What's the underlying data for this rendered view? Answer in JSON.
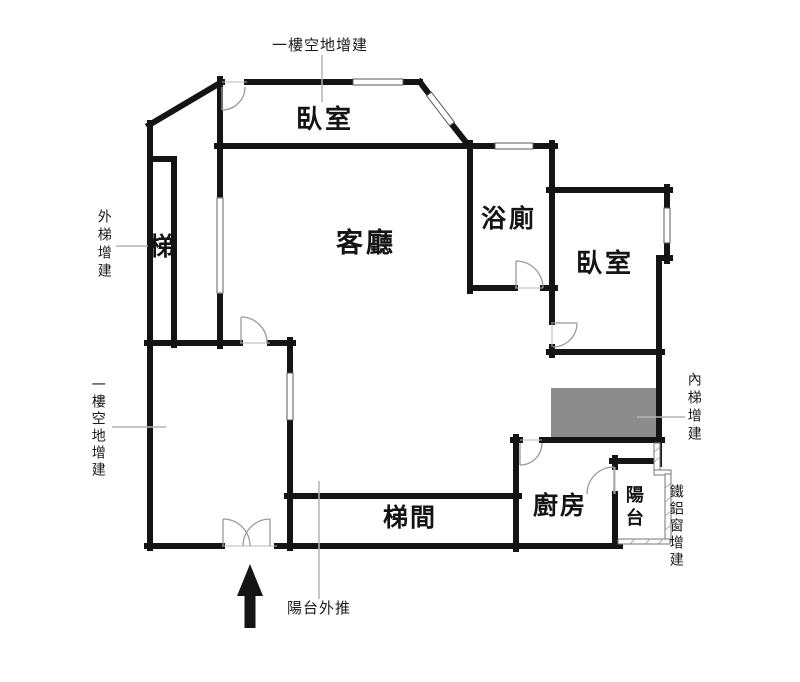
{
  "image_type": "apartment floor plan with addition annotations",
  "rooms": {
    "bedroom_top": "臥室",
    "living_room": "客廳",
    "bathroom": "浴廁",
    "bedroom_right": "臥室",
    "stair": "梯",
    "stairwell": "梯間",
    "kitchen": "廚房",
    "balcony": "陽台"
  },
  "annotations": {
    "ground_floor_addition_top": "一樓空地增建",
    "exterior_stair_addition": "外梯增建",
    "ground_floor_addition_left": "一樓空地增建",
    "balcony_extension": "陽台外推",
    "interior_stair_addition": "內梯增建",
    "metal_window_addition": "鐵鋁窗增建"
  },
  "colors": {
    "wall": "#141414",
    "interior_stair_fill": "#8c8c8c",
    "leader_line": "#b3b3b3",
    "door_arc": "#9a9a9a",
    "background": "#ffffff"
  }
}
